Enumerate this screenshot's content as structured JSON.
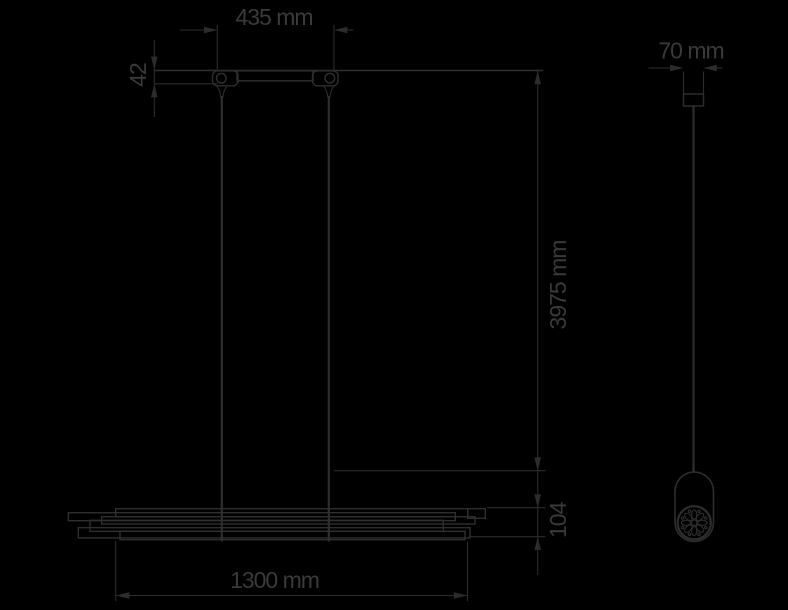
{
  "page": {
    "background": "#000000"
  },
  "drawing": {
    "type": "technical-dimension-diagram",
    "subject": "linear pendant lamp — front view and side view with dimensions",
    "line_color": "#2e2e2e",
    "label_color": "#3a3a3a",
    "unit": "mm",
    "dimensions": {
      "canopy_width": {
        "label": "435 mm",
        "value": 435
      },
      "canopy_height": {
        "label": "42",
        "value": 42
      },
      "suspension_length": {
        "label": "3975 mm",
        "value": 3975
      },
      "body_height": {
        "label": "104",
        "value": 104
      },
      "body_width": {
        "label": "1300 mm",
        "value": 1300
      },
      "side_width": {
        "label": "70 mm",
        "value": 70
      }
    }
  }
}
